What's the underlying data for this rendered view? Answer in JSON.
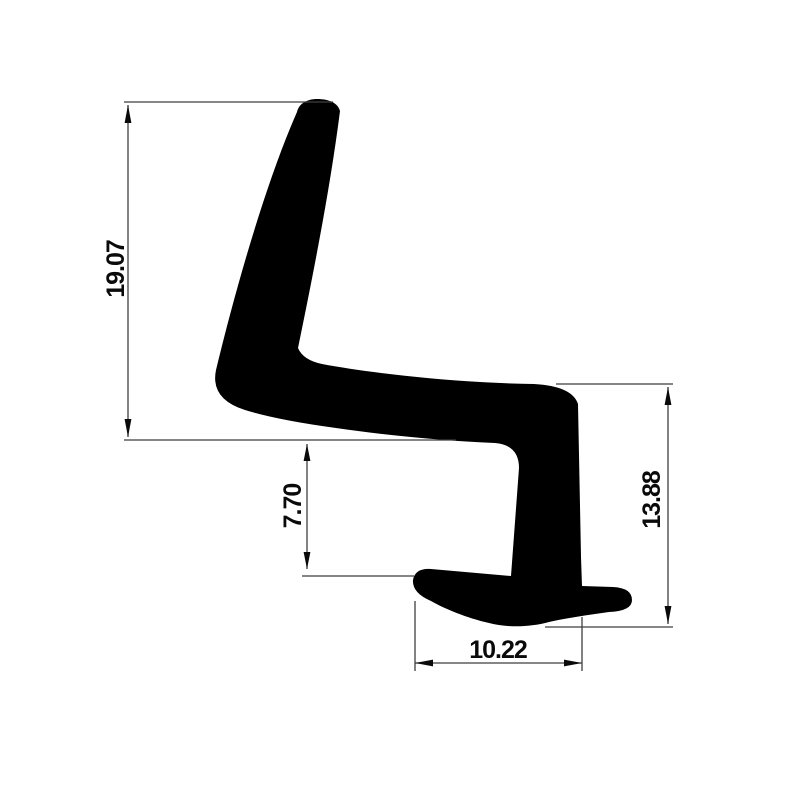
{
  "drawing": {
    "colors": {
      "background": "#ffffff",
      "profile": "#000000",
      "dimension_lines": "#3f3f3f",
      "label_text": "#0a0a0a"
    },
    "dimension_labels": {
      "left_height": "19.07",
      "inner_height": "7.70",
      "right_height": "13.88",
      "bottom_width": "10.22"
    }
  }
}
